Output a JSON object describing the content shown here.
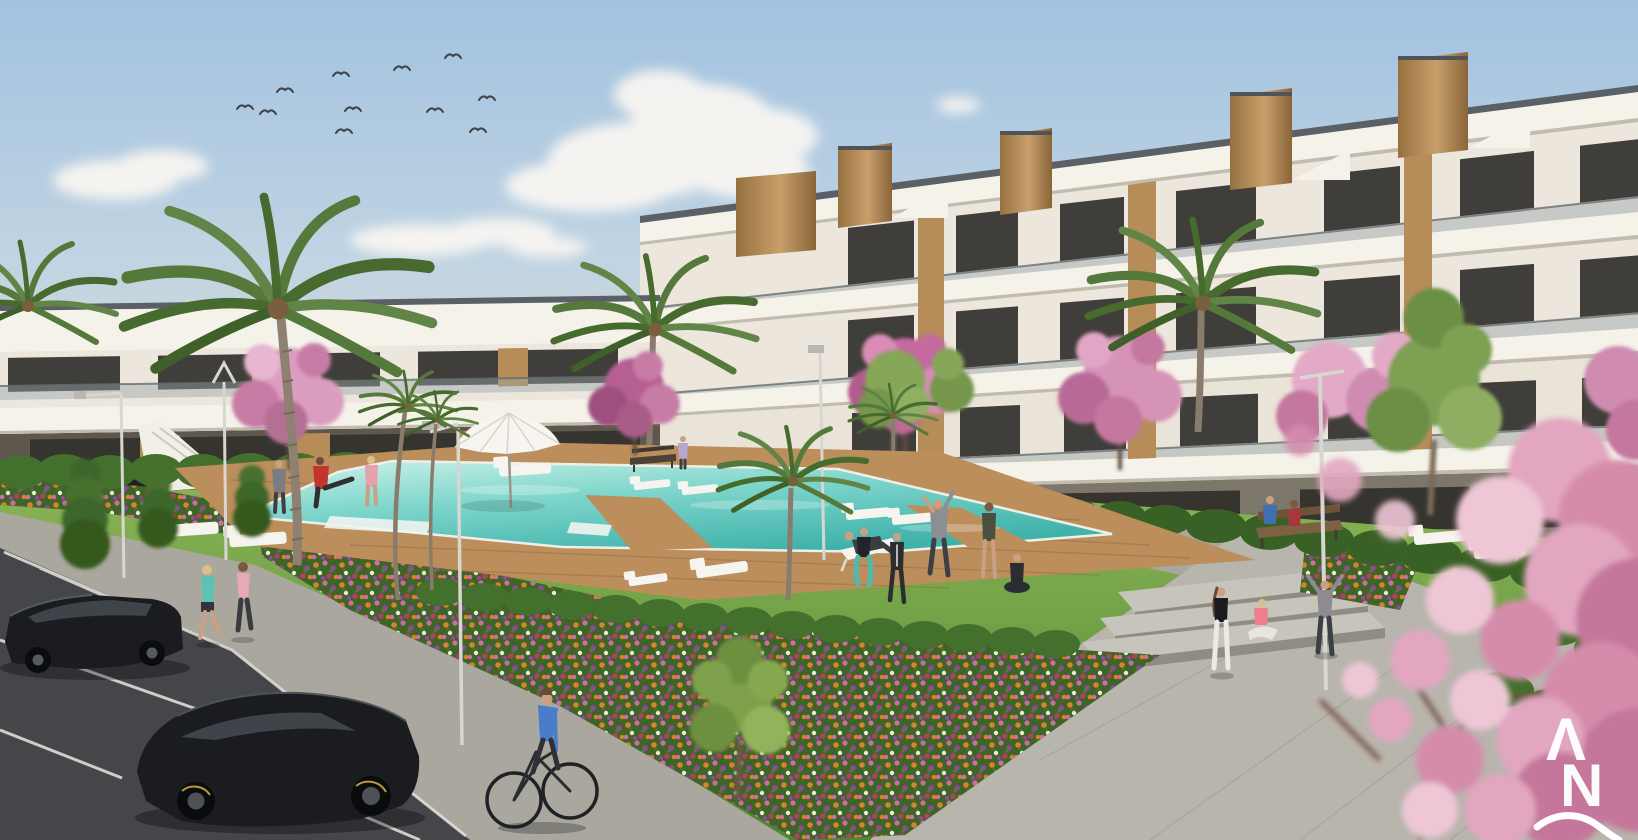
{
  "scene": {
    "type": "architectural-exterior-render",
    "description": "Modern white Mediterranean apartment complex with wood-clad stair towers, communal turquoise pool on a timber deck, lawns with people exercising, flower beds, cherry-blossom and palm trees, parking with two black cars, joggers and a cyclist under a blue sky with birds",
    "counts": {
      "birds": 11,
      "people": 17,
      "cars": 2,
      "bicycles": 1,
      "palm_trees": 7,
      "blossom_trees": 6,
      "sun_loungers": 11,
      "street_lamps": 5,
      "benches": 2
    }
  },
  "palette": {
    "sky_top": "#a2c2e0",
    "sky_mid": "#c0d4e3",
    "sky_horizon": "#ded9d0",
    "cloud": "#f8f5f1",
    "building_white": "#f5f2ea",
    "building_face": "#ece6dc",
    "coping": "#5a6065",
    "glass": "#403e3a",
    "glass_ground": "#36342f",
    "balustrade": "#9aa6a8",
    "wood": "#b68d58",
    "hedge": "#44702d",
    "hedge_dark": "#3a6125",
    "lawn_light": "#8cb558",
    "lawn_dark": "#4f8630",
    "deck": "#bb8e5c",
    "pool_light": "#cdf1e9",
    "pool_deep": "#3fb2aa",
    "path": "#aaa79f",
    "plaza": "#b8b5ad",
    "step_riser": "#8f8c83",
    "step_top": "#c7c4bb",
    "asphalt": "#44464a",
    "road_line": "#dfdcd5",
    "car_body": "#1a1c1f",
    "car_glass": "#3e444a",
    "blossom": "#df9fc0",
    "blossom_deep": "#b06288",
    "palm_green": "#55793a",
    "trunk": "#8d7f6f",
    "flower_orange": "#d9812d",
    "flower_pink": "#cf6da5",
    "flower_purple": "#8e4a9c",
    "flower_white": "#eeead9",
    "flower_crimson": "#b23f63",
    "skin": "#c9a084",
    "white": "#f6f5f0"
  },
  "watermark": {
    "letter_top": "Λ",
    "letter_bottom": "N"
  }
}
